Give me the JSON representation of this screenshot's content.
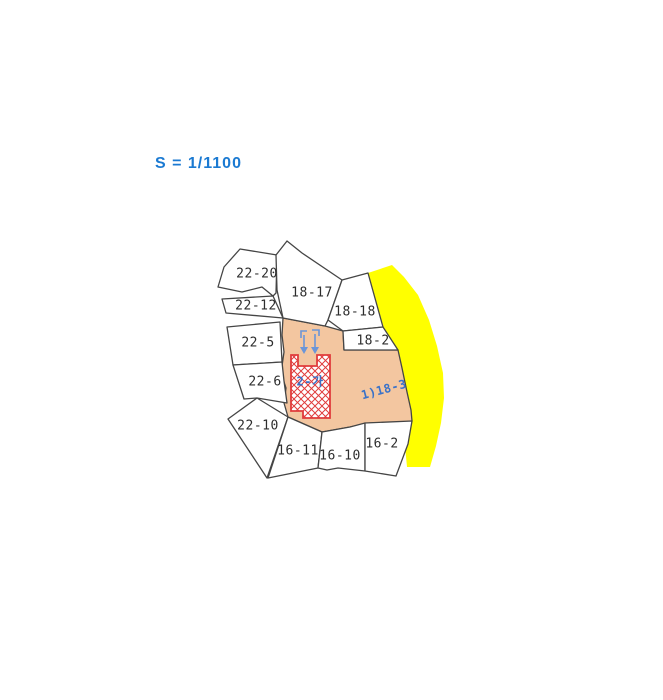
{
  "scale": {
    "text": "S = 1/1100",
    "color": "#1b7ad2"
  },
  "map": {
    "line_color": "#454545",
    "label_color": "#2d2d2d",
    "blue_label_color": "#3a72c8",
    "road": {
      "name": "road-strip",
      "fill": "#ffff00",
      "points": "368,273 392,265 404,277 418,295 429,320 437,346 443,373 444,398 441,423 436,446 430,467 407,467 405,446 403,423 400,399 396,374 389,346 381,318 374,294"
    },
    "highlight_parcel": {
      "id": "1)18-3",
      "fill": "#f3c6a0",
      "points": "283,318 325,326 343,331 344,350 398,350 402,368 407,392 411,410 412,421 394,423 370,423 350,427 322,432 288,417 284,403 286,388 281,373 284,352 282,335",
      "label": {
        "text": "1)18-3",
        "x": 384,
        "y": 390,
        "rotation": -15
      }
    },
    "parcels": [
      {
        "id": "22-20",
        "points": "224,267 240,249 277,255 276,293 273,296 262,287 242,292 218,287",
        "label": {
          "text": "22-20",
          "x": 257,
          "y": 274
        }
      },
      {
        "id": "18-17",
        "points": "276,255 287,241 302,253 342,280 328,320 325,326 283,318 277,290",
        "label": {
          "text": "18-17",
          "x": 312,
          "y": 293
        }
      },
      {
        "id": "22-12",
        "points": "222,299 273,296 283,318 226,313",
        "label": {
          "text": "22-12",
          "x": 256,
          "y": 306
        }
      },
      {
        "id": "18-18",
        "points": "342,280 368,273 383,327 343,331 328,320",
        "label": {
          "text": "18-18",
          "x": 355,
          "y": 312
        }
      },
      {
        "id": "22-5",
        "points": "227,327 280,322 282,362 233,365",
        "label": {
          "text": "22-5",
          "x": 258,
          "y": 343
        }
      },
      {
        "id": "18-2",
        "points": "343,331 383,327 398,350 344,350",
        "label": {
          "text": "18-2",
          "x": 373,
          "y": 341
        }
      },
      {
        "id": "22-6",
        "points": "233,365 282,362 284,381 287,403 257,398 244,399",
        "label": {
          "text": "22-6",
          "x": 265,
          "y": 382
        }
      },
      {
        "id": "22-10",
        "points": "257,398 288,417 267,478 228,419",
        "label": {
          "text": "22-10",
          "x": 258,
          "y": 426
        }
      },
      {
        "id": "16-11",
        "points": "288,417 322,432 318,468 268,478",
        "label": {
          "text": "16-11",
          "x": 298,
          "y": 451
        }
      },
      {
        "id": "16-10",
        "points": "322,432 350,427 365,423 365,471 338,468 327,470 318,468",
        "label": {
          "text": "16-10",
          "x": 340,
          "y": 456
        }
      },
      {
        "id": "16-2",
        "points": "365,423 412,421 408,444 396,476 365,471",
        "label": {
          "text": "16-2",
          "x": 382,
          "y": 444
        }
      }
    ],
    "building": {
      "name": "building-footprint",
      "outline_color": "#e03c3c",
      "path": "M291,355 L298,355 L298,366 L317,366 L317,355 L330,355 L330,418 L303,418 L303,411 L291,411 Z",
      "label": {
        "text": "2-가",
        "x": 310,
        "y": 382
      }
    },
    "symbols": {
      "color": "#6b95d8",
      "items": [
        {
          "name": "survey-arrow-icon",
          "hook": "M301,338 L301,331 L307,331",
          "shaft": "M304,335 L304,348",
          "head": "M300,347 L308,347 L304,354 Z"
        },
        {
          "name": "survey-arrow-icon",
          "hook": "M312,330 L319,330 L319,336",
          "shaft": "M315,334 L315,348",
          "head": "M311,347 L319,347 L315,354 Z"
        }
      ]
    }
  }
}
